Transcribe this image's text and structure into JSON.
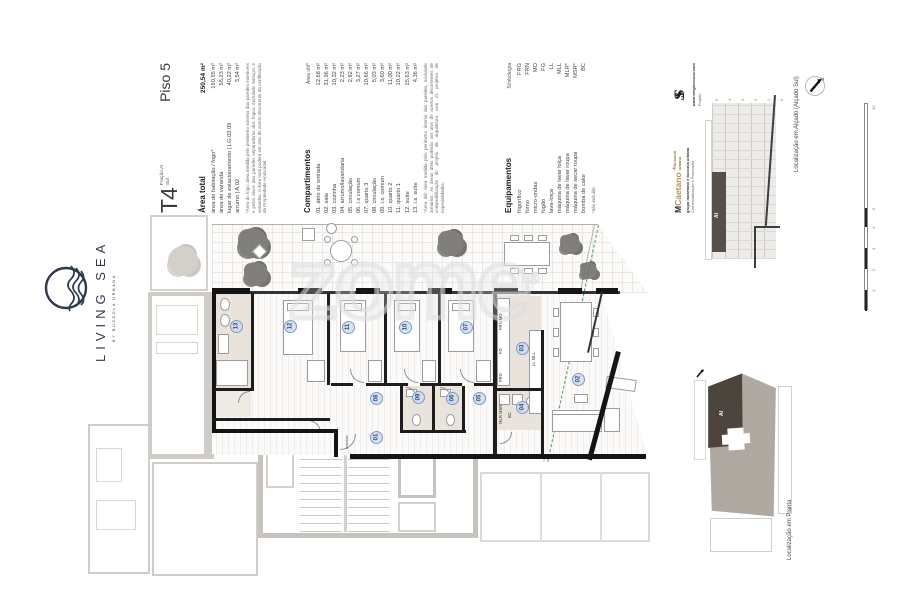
{
  "brand": {
    "name": "LIVING SEA",
    "tagline": "BY BÚSSOLA URBANA"
  },
  "header": {
    "type": "T4",
    "fraction": "Fração AI",
    "orientation": "Sul",
    "floor": "Piso 5"
  },
  "area_total": {
    "title": "Área total",
    "total_value": "250,54 m²",
    "rows": [
      {
        "label": "área de habitação / fogo*",
        "value": "150,55 m²"
      },
      {
        "label": "área de varanda",
        "value": "56,23 m²"
      },
      {
        "label": "lugar de estacionamento | LG.03.09",
        "value": "40,22 m²"
      },
      {
        "label": "arrumo | A.02",
        "value": "3,54 m²"
      }
    ],
    "footnote": "*Área do fogo: área medida pelo perímetro exterior das paredes exteriores e pelos eixos das paredes separadoras dos fogos, excluindo terraços e varandas. A área total poderá ser alvo de acerto decorrente da certificação da Propriedade Horizontal."
  },
  "compartments": {
    "title": "Compartimentos",
    "column_header": "Área útil*",
    "rows": [
      {
        "label": "01. átrio de entrada",
        "value": "12,68 m²"
      },
      {
        "label": "02. sala",
        "value": "31,96 m²"
      },
      {
        "label": "03. cozinha",
        "value": "10,32 m²"
      },
      {
        "label": "04. arrumo/lavandaria",
        "value": "2,23 m²"
      },
      {
        "label": "05. circulação",
        "value": "2,82 m²"
      },
      {
        "label": "06. i.s comum",
        "value": "3,27 m²"
      },
      {
        "label": "07. quarto 3",
        "value": "10,66 m²"
      },
      {
        "label": "08. circulação",
        "value": "5,03 m²"
      },
      {
        "label": "09. i.s. comum",
        "value": "3,60 m²"
      },
      {
        "label": "10. quarto 2",
        "value": "11,00 m²"
      },
      {
        "label": "11. quarto 1",
        "value": "10,22 m²"
      },
      {
        "label": "12. suíte",
        "value": "15,63 m²"
      },
      {
        "label": "13. i.s. suíte",
        "value": "4,36 m²"
      }
    ],
    "footnote": "*Área útil: área medida pelo perímetro interior das paredes, excluindo armários. As áreas úteis poderão ser alvo de acertos decorrentes de compatibilização do projeto de arquitetura com os projetos de especialidades."
  },
  "equipment": {
    "title": "Equipamentos",
    "column_header": "Simbologia",
    "rows": [
      {
        "label": "frigorífico",
        "value": "FRG"
      },
      {
        "label": "forno",
        "value": "FRN"
      },
      {
        "label": "micro-ondas",
        "value": "MO"
      },
      {
        "label": "fogão",
        "value": "FG"
      },
      {
        "label": "lava-loiça",
        "value": "LL"
      },
      {
        "label": "máquina de lavar loiça",
        "value": "MLL"
      },
      {
        "label": "máquina de lavar roupa",
        "value": "MLR*"
      },
      {
        "label": "máquina de secar roupa",
        "value": "MSR*"
      },
      {
        "label": "bomba de calor",
        "value": "BC"
      }
    ],
    "footnote": "*não incluído"
  },
  "credits": {
    "developer_logo_m": "M",
    "developer_logo_rest": "Caetano",
    "bussola_star": "✳",
    "bussola_line1": "bússola",
    "bussola_line2": "urbana",
    "developer_caption": "grupo mcaetano e bússola urbana",
    "developer_role": "Comercialização e Promoção",
    "architect_logo": "S",
    "architect_caption": "www.sergiosousa.com",
    "architect_role": "Projeto"
  },
  "plan": {
    "watermark": "zome",
    "registered": "®",
    "entrance_label": "entrada",
    "room_badges": [
      "01",
      "02",
      "03",
      "04",
      "05",
      "06",
      "07",
      "08",
      "09",
      "10",
      "11",
      "12",
      "13"
    ],
    "kitchen_labels": {
      "oven_micro": "FRN MO",
      "hob": "FG",
      "fridge": "FRG",
      "sink_dw": "LL MLL",
      "laundry": "MLR MSR",
      "heat_pump": "BC"
    }
  },
  "elevation": {
    "label": "Localização em Alçado (Alçado Sul)",
    "unit_tag": "AI",
    "floor_ticks": [
      "5",
      "4",
      "3",
      "2",
      "1",
      "0"
    ]
  },
  "site_plan": {
    "label": "Localização em Planta",
    "unit_tag": "AI"
  },
  "scale_bar": {
    "ticks": [
      "10",
      "5",
      "4",
      "3",
      "2",
      "1"
    ]
  },
  "compass": {
    "north_label": "N"
  }
}
